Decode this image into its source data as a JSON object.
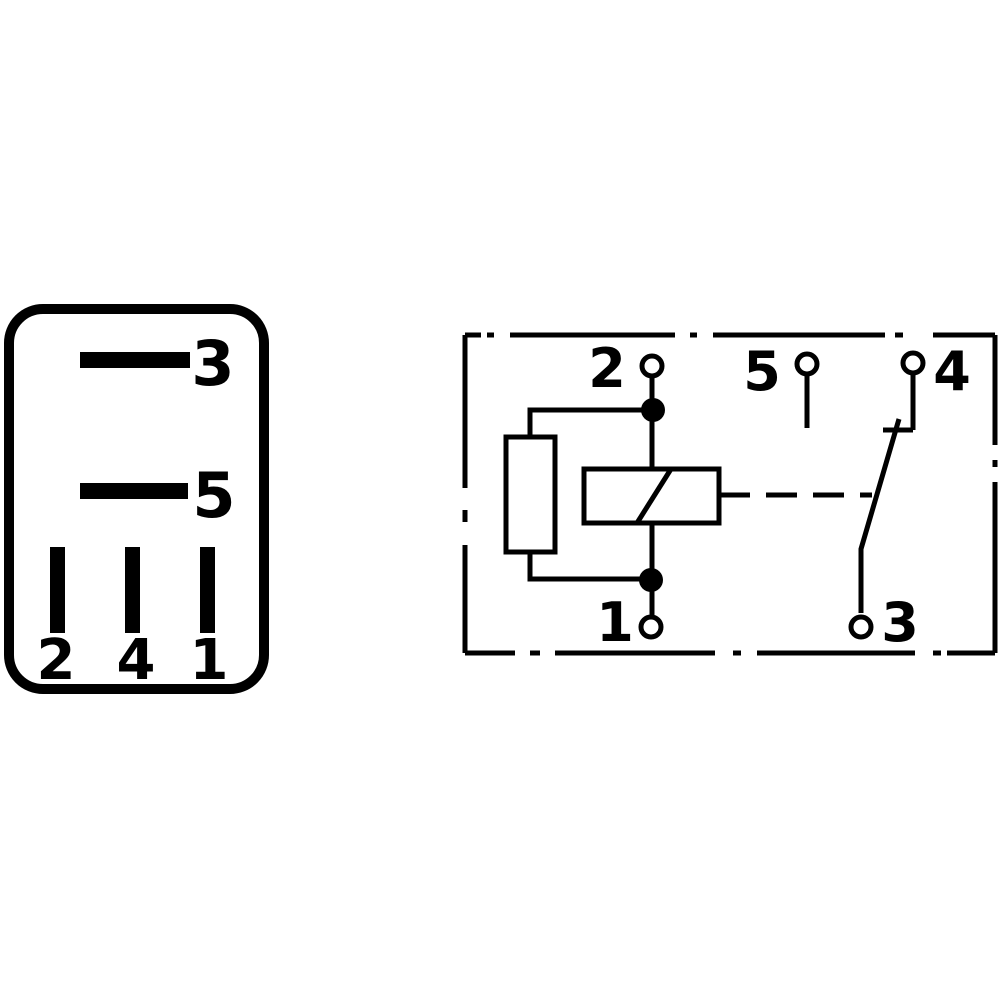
{
  "page": {
    "background_color": "#ffffff",
    "line_color": "#000000",
    "subject": "relay pin layout and internal circuit schematic"
  },
  "pin_view": {
    "name": "relay-base-pin-layout",
    "labels": {
      "pin3": "3",
      "pin5": "5",
      "pin2": "2",
      "pin4": "4",
      "pin1": "1"
    }
  },
  "schematic": {
    "name": "relay-circuit-schematic",
    "terminal_labels": {
      "t2": "2",
      "t5": "5",
      "t4": "4",
      "t1": "1",
      "t3": "3"
    },
    "components": {
      "resistor": "resistor",
      "coil": "relay-coil",
      "switch": "changeover-contact",
      "boundary": "dash-dot-enclosure"
    }
  }
}
